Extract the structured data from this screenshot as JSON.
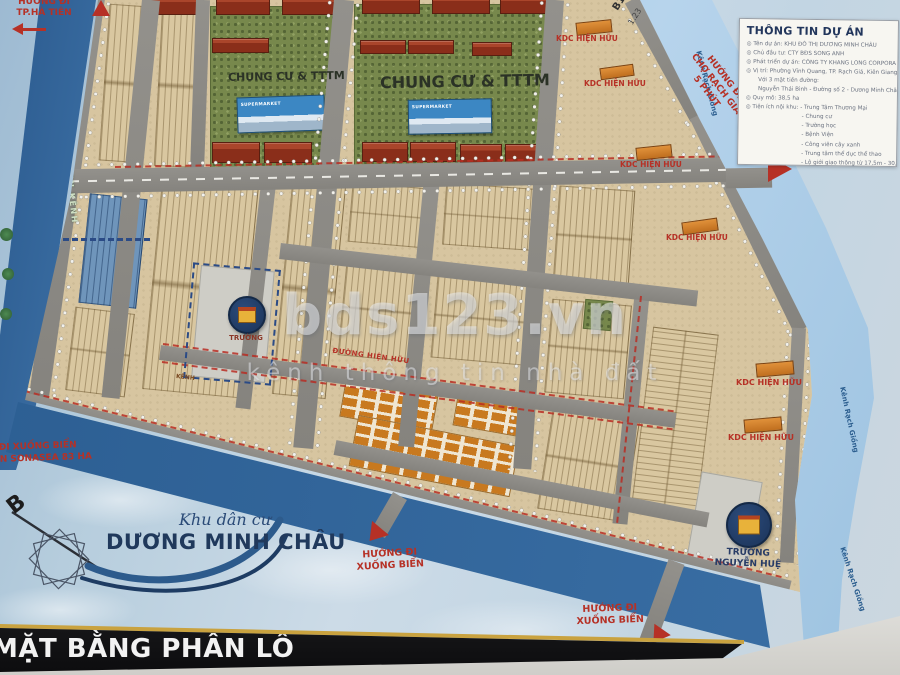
{
  "watermark": {
    "brand": "bds123.vn",
    "tagline": "kênh thông tin nhà đất"
  },
  "title_bar": {
    "label": "MẶT BẰNG PHÂN LÔ"
  },
  "logo": {
    "script": "Khu dân cư",
    "name": "DƯƠNG MINH CHÂU"
  },
  "compass": {
    "north": "B"
  },
  "info_box": {
    "title": "THÔNG TIN DỰ ÁN",
    "rows": [
      "◎ Tên dự án: KHU ĐÔ THỊ DƯƠNG MINH CHÂU",
      "◎ Chủ đầu tư: CTY BĐS SONG ANH",
      "◎ Phát triển dự án: CÔNG TY KHANG LONG CORPORA",
      "◎ Vị trí: Phường Vĩnh Quang, TP. Rạch Giá, Kiên Giang.",
      "Với 3 mặt tiền đường:",
      "Nguyễn Thái Bình - Đường số 2 - Dương Minh Châu",
      "◎ Quy mô: 38,5 ha",
      "◎ Tiện ích nội khu:  - Trung Tâm Thương Mại",
      "- Chung cư",
      "- Trường học",
      "- Bệnh Viện",
      "- Công viên cây xanh",
      "- Trung tâm thể dục thể thao",
      "- Lộ giới giao thông từ 17,5m - 30,5m",
      "◎ Pháp lý: 1/500 đã được phê duyệt, đất thổ cư 100%"
    ]
  },
  "labels": {
    "chung_cu": "CHUNG CƯ & TTTM",
    "supermarket": "SUPERMARKET",
    "kdc": "KDC HIỆN HỮU",
    "existing_road": "ĐƯỜNG HIỆN HỮU",
    "canal_small": "KÊNH",
    "school": "TRƯỜNG",
    "school_nh_1": "TRƯỜNG",
    "school_nh_2": "NGUYỄN HUỆ",
    "canal_park": "CÔNG VIÊN VEN KÊNH",
    "river_name": "Kênh Rạch Giồng",
    "corner_mark_1": "B1",
    "corner_mark_2": "1.23"
  },
  "directions": {
    "ha_tien_1": "HƯỚNG ĐI",
    "ha_tien_2": "TP.HÀ TIÊN",
    "rach_gia_1": "HƯỚNG ĐI",
    "rach_gia_2": "CHỢ RẠCH GIÁ",
    "rach_gia_3": "5 PHÚT",
    "sea_left_1": "ĐƯỜNG ĐI XUỐNG BIỂN",
    "sea_left_2": "VÀ DỰ ÁN SONASEA 83 HA",
    "sea_mid_1": "HƯỚNG ĐI",
    "sea_mid_2": "XUỐNG BIỂN",
    "sea_right_1": "HƯỚNG ĐI",
    "sea_right_2": "XUỐNG BIỂN"
  },
  "colors": {
    "accent_red": "#b63126",
    "road_grey": "#8d8b86",
    "lot_tan": "#d7c5a0",
    "canal_blue": "#2f6196",
    "river_blue": "#a7c9e3",
    "green": "#77884c",
    "navy": "#1e3a5f",
    "gold": "#c9a23f",
    "roof_red": "#9a3a22",
    "orange": "#cd7f2c"
  }
}
